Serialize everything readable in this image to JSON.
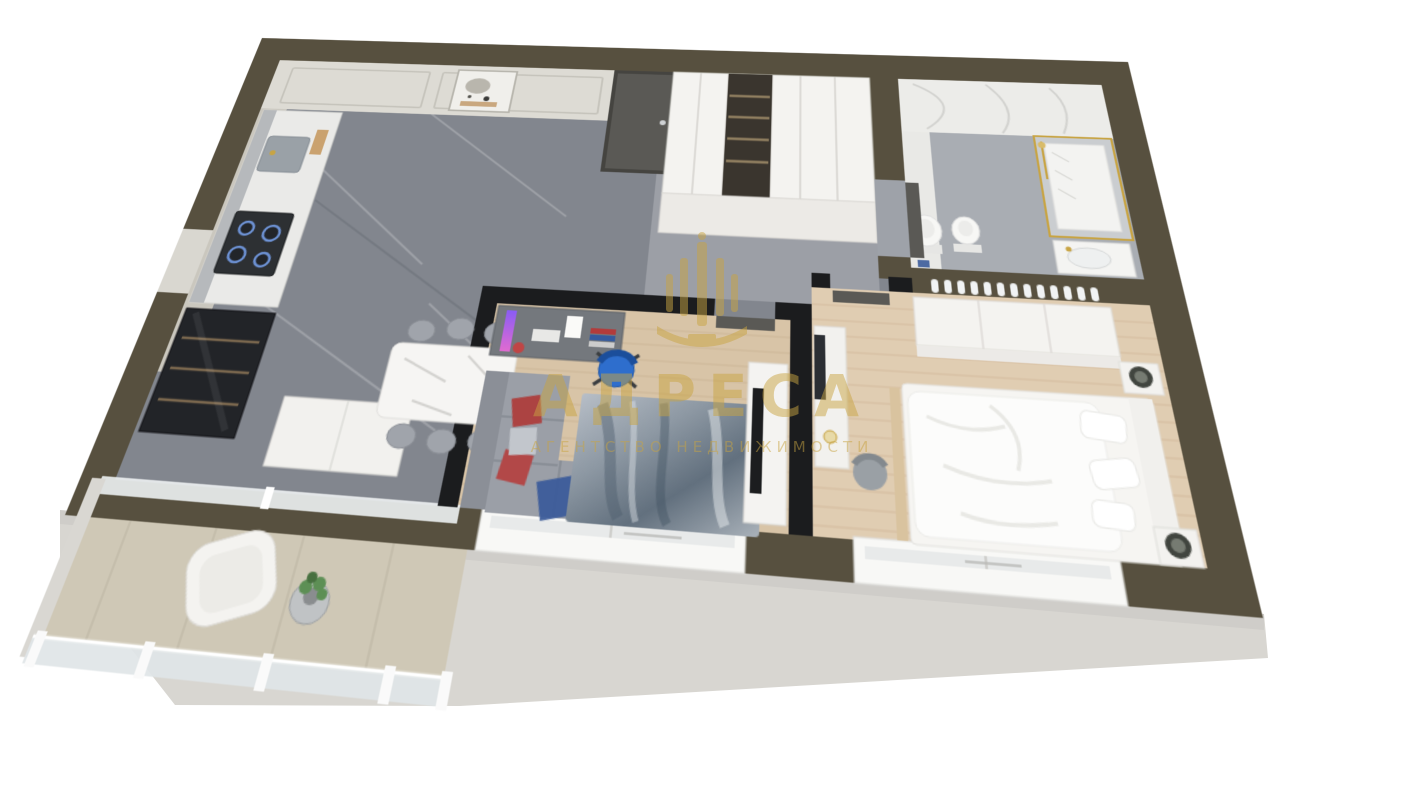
{
  "watermark": {
    "title": "АДРЕСА",
    "subtitle": "АГЕНТСТВО НЕДВИЖИМОСТИ",
    "color": "#C8A443",
    "opacity": "0.5",
    "logo": "fountain-column-emblem"
  },
  "scene": {
    "kind": "3d-cutaway-floor-plan-render-of-one-bedroom-apartment",
    "background": "#FFFFFF",
    "colors": {
      "exterior_wall": "#57503F",
      "partition_wall": "#1B1C1E",
      "wall_face": "#DDDBD4",
      "outer_face": "#D8D6D1",
      "marble_floor": "#82868E",
      "marble_floor_light": "#9EA2A9",
      "bath_floor": "#A9ADB3",
      "bath_wall": "#ECECE9",
      "wood_floor_office": "#D8C4A7",
      "wood_floor_bedroom": "#E0CDB2",
      "balcony_floor": "#CFC8B6",
      "white_furniture": "#F4F3F0",
      "door_gray": "#5A5955",
      "sofa_gray": "#9B9FA7",
      "pillow_red": "#AC4342",
      "throw_blue": "#3C5C9A",
      "office_chair_blue": "#2E6ECD",
      "dark_cabinet": "#222428",
      "tv_black": "#1C1D1F",
      "gold": "#C8A443"
    }
  }
}
